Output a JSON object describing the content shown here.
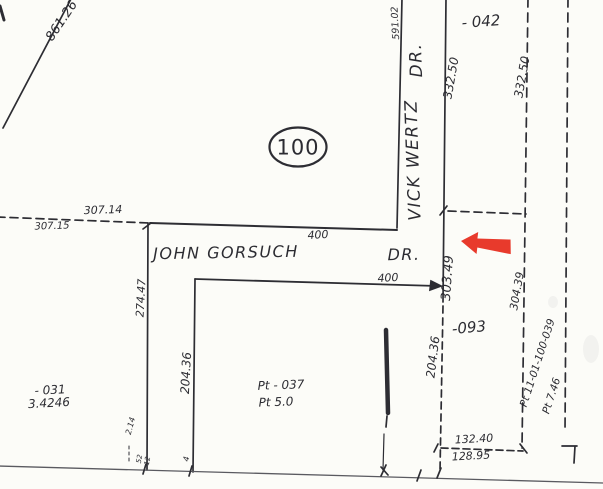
{
  "map": {
    "bg_color": "#fcfcf8",
    "ink_color": "#2d2d33",
    "streets": {
      "vick_wertz": {
        "name": "VICK WERTZ",
        "suffix": "DR."
      },
      "john_gorsuch": {
        "name": "JOHN GORSUCH",
        "suffix": "DR."
      }
    },
    "parcels": {
      "lot_oval": "100",
      "lot_042": "- 042",
      "lot_093": "-093",
      "lot_031": {
        "id": "- 031",
        "acreage": "3.4246"
      },
      "lot_037": {
        "id": "Pt - 037",
        "acreage": "Pt 5.0"
      },
      "lot_039": {
        "id": "Pt 11-01-100-039",
        "acreage": "Pt 7.46"
      }
    },
    "dimensions": {
      "d_861_26": "861.26",
      "d_591_02": "591.02",
      "d_332_50_a": "332.50",
      "d_332_50_b": "332.50",
      "d_307_14": "307.14",
      "d_307_15": "307.15",
      "d_400_a": "400",
      "d_400_b": "400",
      "d_274_47": "274.47",
      "d_303_49": "303.49",
      "d_304_39": "304.39",
      "d_204_36_a": "204.36",
      "d_204_36_b": "204.36",
      "d_132_40": "132.40",
      "d_128_95": "128.95",
      "d_2_14": "2.14",
      "d_52": "52",
      "d_12": "12",
      "d_4": "4"
    },
    "marker": {
      "type": "arrow-left",
      "color": "#e83a2c"
    }
  }
}
